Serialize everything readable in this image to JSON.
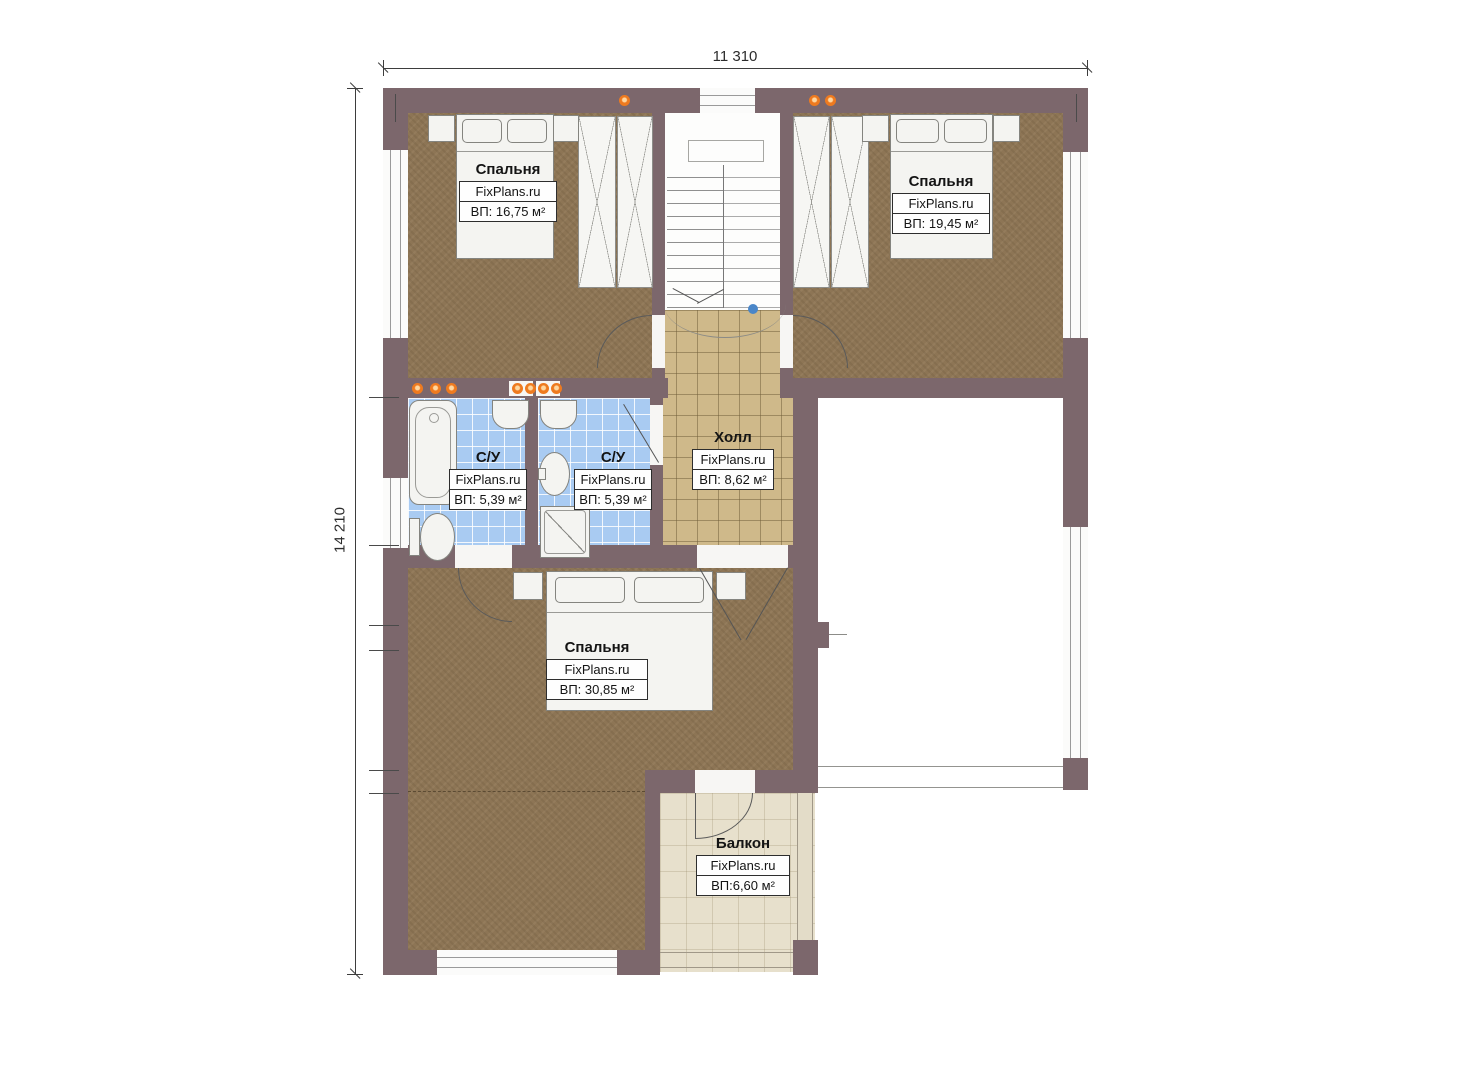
{
  "plan": {
    "title": "floor-plan-second-storey",
    "dimensions": {
      "width_label": "11 310",
      "height_label": "14 210"
    },
    "rooms": [
      {
        "name": "Спальня",
        "site": "FixPlans.ru",
        "area": "ВП: 16,75 м²"
      },
      {
        "name": "Спальня",
        "site": "FixPlans.ru",
        "area": "ВП: 19,45 м²"
      },
      {
        "name": "С/У",
        "site": "FixPlans.ru",
        "area": "ВП: 5,39 м²"
      },
      {
        "name": "С/У",
        "site": "FixPlans.ru",
        "area": "ВП: 5,39 м²"
      },
      {
        "name": "Холл",
        "site": "FixPlans.ru",
        "area": "ВП: 8,62 м²"
      },
      {
        "name": "Спальня",
        "site": "FixPlans.ru",
        "area": "ВП: 30,85 м²"
      },
      {
        "name": "Балкон",
        "site": "FixPlans.ru",
        "area": "ВП:6,60 м²"
      }
    ],
    "colors": {
      "wall": "#7c676c",
      "bedroom_floor": "#8d7555",
      "hall_floor": "#cfb98a",
      "bath_floor": "#a9cbf2",
      "balcony_floor": "#e7e0cc",
      "light_accent": "#ee7a1f",
      "marker_blue": "#4a86c8"
    }
  }
}
